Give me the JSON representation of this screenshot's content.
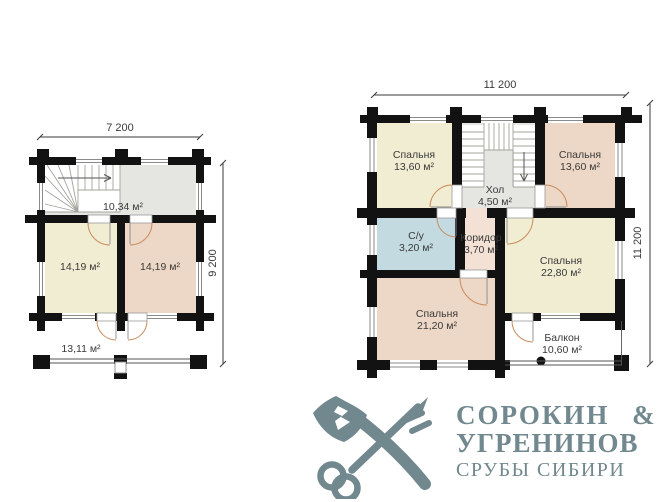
{
  "floorplan_left": {
    "dim_width": "7 200",
    "dim_height": "9 200",
    "hall": {
      "area": "10,34 м²"
    },
    "room_left": {
      "area": "14,19 м²"
    },
    "room_right": {
      "area": "14,19 м²"
    },
    "terrace": {
      "area": "13,11 м²"
    }
  },
  "floorplan_right": {
    "dim_width": "11 200",
    "dim_height": "11 200",
    "bedroom_top_left": {
      "name": "Спальня",
      "area": "13,60 м²"
    },
    "bedroom_top_right": {
      "name": "Спальня",
      "area": "13,60 м²"
    },
    "hall": {
      "name": "Хол",
      "area": "4,50 м²"
    },
    "bathroom": {
      "name": "С/у",
      "area": "3,20 м²"
    },
    "corridor": {
      "name": "Коридор",
      "area": "3,70 м²"
    },
    "bedroom_right": {
      "name": "Спальня",
      "area": "22,80 м²"
    },
    "bedroom_bottom": {
      "name": "Спальня",
      "area": "21,20 м²"
    },
    "balcony": {
      "name": "Балкон",
      "area": "10,60 м²"
    }
  },
  "logo": {
    "line1": "СОРОКИН &",
    "line2": "УГРЕНИНОВ",
    "line3": "СРУБЫ СИБИРИ",
    "color": "#72888f"
  },
  "colors": {
    "wall": "#121212",
    "hall_grey": "#e5e5e1",
    "cream": "#f1edd2",
    "pink": "#edd7c6",
    "corridor_pink": "#f3e1d5",
    "blue": "#c3dbe0",
    "door_arc": "#c98c5c"
  }
}
